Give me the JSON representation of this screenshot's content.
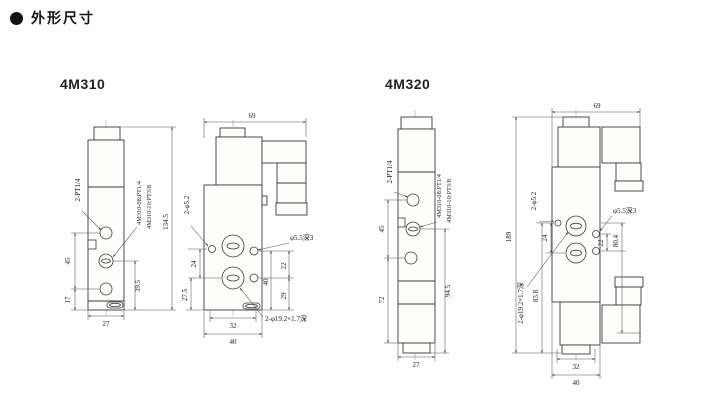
{
  "page": {
    "title": "外形尺寸"
  },
  "sections": {
    "model_a": "4M310",
    "model_b": "4M320"
  },
  "a_side": {
    "port_label": "2-PT1/4",
    "spec_line1": "4M310-08:PT1/4",
    "spec_line2": "4M310-10:PT3/8",
    "dim_port_span": "45",
    "dim_bottom_port": "17",
    "dim_right": "39.5",
    "dim_height": "134.5",
    "dim_width": "27"
  },
  "a_front": {
    "dim_top_width": "69",
    "mount_holes_label": "2-φ5.2",
    "dim_left_inner": "24",
    "dim_left_outer": "27.5",
    "hole_depth_label": "φ5.5深3",
    "dim_right_top": "22",
    "dim_right_outer": "40",
    "dim_right_bottom": "29",
    "dim_bottom_inner": "32",
    "dim_bottom_outer": "40",
    "port_slot_label": "2-φ19.2×1.7深"
  },
  "b_side": {
    "port_label": "2-PT1/4",
    "spec_line1": "4M310-08:PT1/4",
    "spec_line2": "4M310-10:PT3/8",
    "dim_port_span": "45",
    "dim_lower": "72",
    "dim_right": "94.5",
    "dim_width": "27"
  },
  "b_front": {
    "dim_top_width": "69",
    "dim_total_height": "189",
    "mount_holes_label": "2-φ5.2",
    "dim_left_inner": "24",
    "dim_left_outer": "83.8",
    "port_slot_label": "2-φ19.2×1.7深",
    "hole_depth_label": "φ5.5深3",
    "dim_right_inner": "22",
    "dim_right_outer": "80.4",
    "dim_bottom_inner": "32",
    "dim_bottom_outer": "40"
  }
}
